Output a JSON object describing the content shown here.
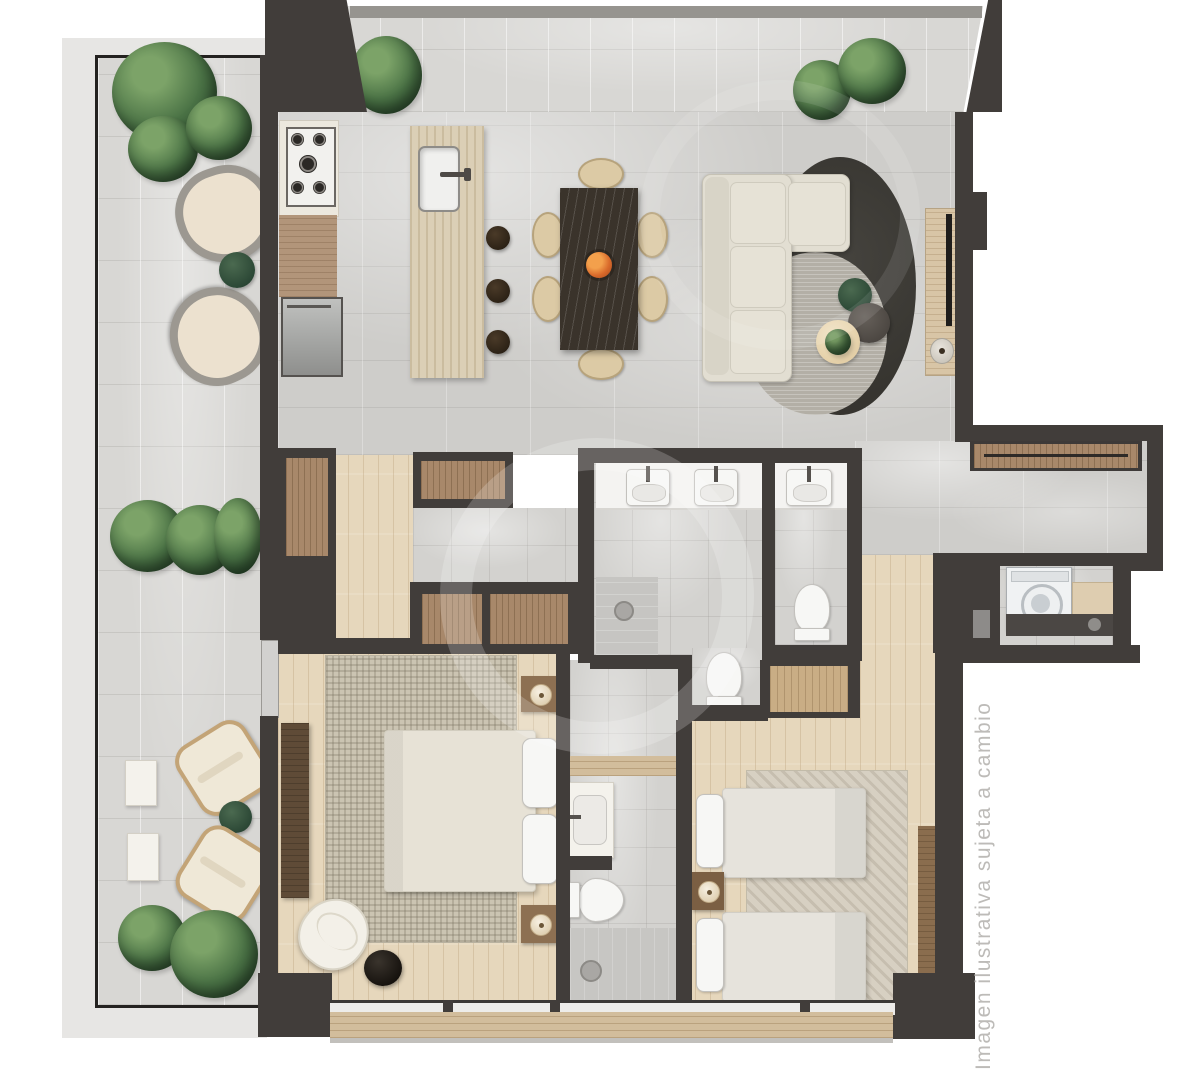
{
  "watermark": {
    "text": "Imagen ilustrativa sujeta a cambio"
  },
  "palette": {
    "background": "#ffffff",
    "wall": "#413d3a",
    "marble_floor": "#cecdca",
    "terrace_stone": "#d8d7d4",
    "wood_floor": "#e6d7bc",
    "closet_wood": "#a8886a",
    "island_travertine": "#dbcfb6",
    "dining_table": "#3a332b",
    "upholstery_beige": "#e2ded2",
    "rug_charcoal": "#3b3937",
    "rug_gray": "#b3afa6",
    "plant_green": "#4a7245",
    "fruit_orange": "#d96a2b",
    "fixture_white": "#f4f3f1",
    "watermark_gray": "#bdbbb8"
  },
  "regions": [
    "terrace",
    "balcony",
    "kitchen",
    "dining-area",
    "living-area",
    "hallway",
    "dressing-area",
    "main-bathroom",
    "guest-bathroom",
    "ensuite-bathroom",
    "master-bedroom",
    "second-bedroom",
    "corridor",
    "laundry"
  ],
  "furniture_icons": {
    "terrace": [
      "potted-plant",
      "potted-plant",
      "wicker-armchair",
      "wicker-armchair",
      "round-garden-table",
      "planter-hedge",
      "side-table-white",
      "side-table-white",
      "sun-lounger",
      "sun-lounger",
      "round-garden-table",
      "potted-plant",
      "potted-plant"
    ],
    "balcony": [
      "potted-plant",
      "potted-plant",
      "potted-plant"
    ],
    "kitchen": [
      "gas-hob",
      "worktop",
      "refrigerator",
      "kitchen-island",
      "island-sink",
      "bar-stool",
      "bar-stool",
      "bar-stool"
    ],
    "dining_area": [
      "dining-table",
      "fruit-bowl",
      "dining-chair",
      "dining-chair",
      "dining-chair",
      "dining-chair",
      "dining-chair",
      "dining-chair"
    ],
    "living_area": [
      "sectional-sofa",
      "round-rug-charcoal",
      "round-rug-gray",
      "coffee-table-green",
      "coffee-table-dark",
      "coffee-table-plant",
      "tv-console",
      "tv"
    ],
    "main_bathroom": [
      "double-vanity",
      "sink",
      "sink",
      "walk-in-shower",
      "toilet"
    ],
    "guest_bathroom": [
      "vanity",
      "sink",
      "toilet"
    ],
    "ensuite_bathroom": [
      "vanity-sink",
      "toilet",
      "walk-in-shower"
    ],
    "master_bedroom": [
      "area-rug",
      "double-bed",
      "pillow",
      "pillow",
      "nightstand",
      "nightstand",
      "table-lamp",
      "table-lamp",
      "dresser-console",
      "accent-chair",
      "round-side-table-black",
      "wardrobe"
    ],
    "second_bedroom": [
      "area-rug",
      "twin-bed",
      "twin-bed",
      "nightstand",
      "table-lamp",
      "wardrobe",
      "wall-console"
    ],
    "laundry": [
      "washing-machine",
      "counter-sink"
    ],
    "corridor": [
      "closet-row"
    ],
    "hallway": [
      "closet",
      "closet"
    ]
  }
}
